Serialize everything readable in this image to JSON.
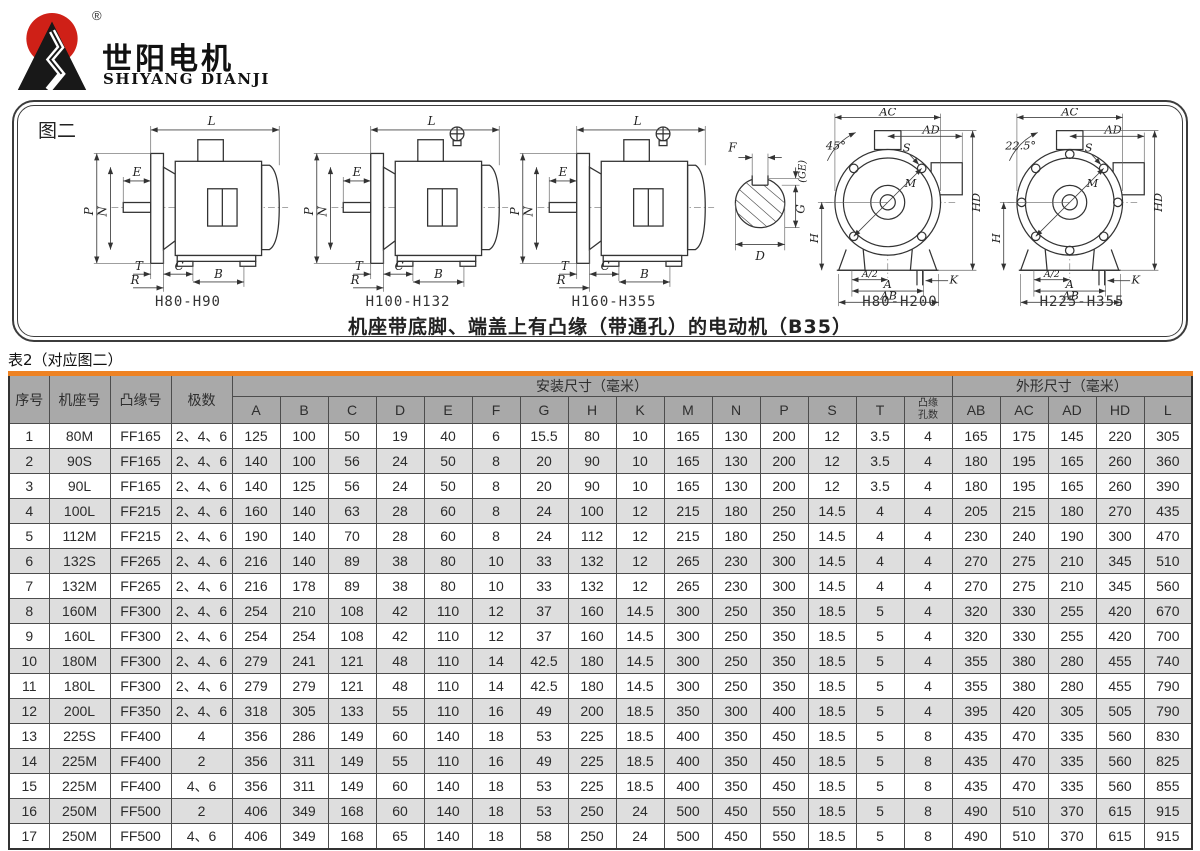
{
  "logo": {
    "company_cn": "世阳电机",
    "company_en": "SHIYANG DIANJI",
    "registered_mark": "®"
  },
  "figure": {
    "label": "图二",
    "caption": "机座带底脚、端盖上有凸缘（带通孔）的电动机（B35）",
    "dim_labels": {
      "L": "L",
      "E": "E",
      "P": "P",
      "N": "N",
      "T": "T",
      "R": "R",
      "C": "C",
      "B": "B",
      "F": "F",
      "GE": "(GE)",
      "G": "G",
      "D": "D",
      "AC": "AC",
      "AD": "AD",
      "S": "S",
      "M": "M",
      "H": "H",
      "HD": "HD",
      "A2": "A/2",
      "A": "A",
      "AB": "AB",
      "K": "K",
      "angle45": "45°",
      "angle225": "22.5°"
    },
    "side_views": [
      {
        "caption": "H80-H90"
      },
      {
        "caption": "H100-H132"
      },
      {
        "caption": "H160-H355"
      }
    ],
    "front_views": [
      {
        "caption": "H80-H200"
      },
      {
        "caption": "H225-H355"
      }
    ]
  },
  "table": {
    "caption": "表2（对应图二）",
    "headers": {
      "col_index": "序号",
      "col_frame": "机座号",
      "col_flange": "凸缘号",
      "col_poles": "极数",
      "group_mounting": "安装尺寸（毫米）",
      "group_overall": "外形尺寸（毫米）",
      "mounting_cols": [
        "A",
        "B",
        "C",
        "D",
        "E",
        "F",
        "G",
        "H",
        "K",
        "M",
        "N",
        "P",
        "S",
        "T",
        "凸缘孔数"
      ],
      "overall_cols": [
        "AB",
        "AC",
        "AD",
        "HD",
        "L"
      ]
    },
    "rows": [
      [
        "1",
        "80M",
        "FF165",
        "2、4、6",
        "125",
        "100",
        "50",
        "19",
        "40",
        "6",
        "15.5",
        "80",
        "10",
        "165",
        "130",
        "200",
        "12",
        "3.5",
        "4",
        "165",
        "175",
        "145",
        "220",
        "305"
      ],
      [
        "2",
        "90S",
        "FF165",
        "2、4、6",
        "140",
        "100",
        "56",
        "24",
        "50",
        "8",
        "20",
        "90",
        "10",
        "165",
        "130",
        "200",
        "12",
        "3.5",
        "4",
        "180",
        "195",
        "165",
        "260",
        "360"
      ],
      [
        "3",
        "90L",
        "FF165",
        "2、4、6",
        "140",
        "125",
        "56",
        "24",
        "50",
        "8",
        "20",
        "90",
        "10",
        "165",
        "130",
        "200",
        "12",
        "3.5",
        "4",
        "180",
        "195",
        "165",
        "260",
        "390"
      ],
      [
        "4",
        "100L",
        "FF215",
        "2、4、6",
        "160",
        "140",
        "63",
        "28",
        "60",
        "8",
        "24",
        "100",
        "12",
        "215",
        "180",
        "250",
        "14.5",
        "4",
        "4",
        "205",
        "215",
        "180",
        "270",
        "435"
      ],
      [
        "5",
        "112M",
        "FF215",
        "2、4、6",
        "190",
        "140",
        "70",
        "28",
        "60",
        "8",
        "24",
        "112",
        "12",
        "215",
        "180",
        "250",
        "14.5",
        "4",
        "4",
        "230",
        "240",
        "190",
        "300",
        "470"
      ],
      [
        "6",
        "132S",
        "FF265",
        "2、4、6",
        "216",
        "140",
        "89",
        "38",
        "80",
        "10",
        "33",
        "132",
        "12",
        "265",
        "230",
        "300",
        "14.5",
        "4",
        "4",
        "270",
        "275",
        "210",
        "345",
        "510"
      ],
      [
        "7",
        "132M",
        "FF265",
        "2、4、6",
        "216",
        "178",
        "89",
        "38",
        "80",
        "10",
        "33",
        "132",
        "12",
        "265",
        "230",
        "300",
        "14.5",
        "4",
        "4",
        "270",
        "275",
        "210",
        "345",
        "560"
      ],
      [
        "8",
        "160M",
        "FF300",
        "2、4、6",
        "254",
        "210",
        "108",
        "42",
        "110",
        "12",
        "37",
        "160",
        "14.5",
        "300",
        "250",
        "350",
        "18.5",
        "5",
        "4",
        "320",
        "330",
        "255",
        "420",
        "670"
      ],
      [
        "9",
        "160L",
        "FF300",
        "2、4、6",
        "254",
        "254",
        "108",
        "42",
        "110",
        "12",
        "37",
        "160",
        "14.5",
        "300",
        "250",
        "350",
        "18.5",
        "5",
        "4",
        "320",
        "330",
        "255",
        "420",
        "700"
      ],
      [
        "10",
        "180M",
        "FF300",
        "2、4、6",
        "279",
        "241",
        "121",
        "48",
        "110",
        "14",
        "42.5",
        "180",
        "14.5",
        "300",
        "250",
        "350",
        "18.5",
        "5",
        "4",
        "355",
        "380",
        "280",
        "455",
        "740"
      ],
      [
        "11",
        "180L",
        "FF300",
        "2、4、6",
        "279",
        "279",
        "121",
        "48",
        "110",
        "14",
        "42.5",
        "180",
        "14.5",
        "300",
        "250",
        "350",
        "18.5",
        "5",
        "4",
        "355",
        "380",
        "280",
        "455",
        "790"
      ],
      [
        "12",
        "200L",
        "FF350",
        "2、4、6",
        "318",
        "305",
        "133",
        "55",
        "110",
        "16",
        "49",
        "200",
        "18.5",
        "350",
        "300",
        "400",
        "18.5",
        "5",
        "4",
        "395",
        "420",
        "305",
        "505",
        "790"
      ],
      [
        "13",
        "225S",
        "FF400",
        "4",
        "356",
        "286",
        "149",
        "60",
        "140",
        "18",
        "53",
        "225",
        "18.5",
        "400",
        "350",
        "450",
        "18.5",
        "5",
        "8",
        "435",
        "470",
        "335",
        "560",
        "830"
      ],
      [
        "14",
        "225M",
        "FF400",
        "2",
        "356",
        "311",
        "149",
        "55",
        "110",
        "16",
        "49",
        "225",
        "18.5",
        "400",
        "350",
        "450",
        "18.5",
        "5",
        "8",
        "435",
        "470",
        "335",
        "560",
        "825"
      ],
      [
        "15",
        "225M",
        "FF400",
        "4、6",
        "356",
        "311",
        "149",
        "60",
        "140",
        "18",
        "53",
        "225",
        "18.5",
        "400",
        "350",
        "450",
        "18.5",
        "5",
        "8",
        "435",
        "470",
        "335",
        "560",
        "855"
      ],
      [
        "16",
        "250M",
        "FF500",
        "2",
        "406",
        "349",
        "168",
        "60",
        "140",
        "18",
        "53",
        "250",
        "24",
        "500",
        "450",
        "550",
        "18.5",
        "5",
        "8",
        "490",
        "510",
        "370",
        "615",
        "915"
      ],
      [
        "17",
        "250M",
        "FF500",
        "4、6",
        "406",
        "349",
        "168",
        "65",
        "140",
        "18",
        "58",
        "250",
        "24",
        "500",
        "450",
        "550",
        "18.5",
        "5",
        "8",
        "490",
        "510",
        "370",
        "615",
        "915"
      ]
    ]
  }
}
